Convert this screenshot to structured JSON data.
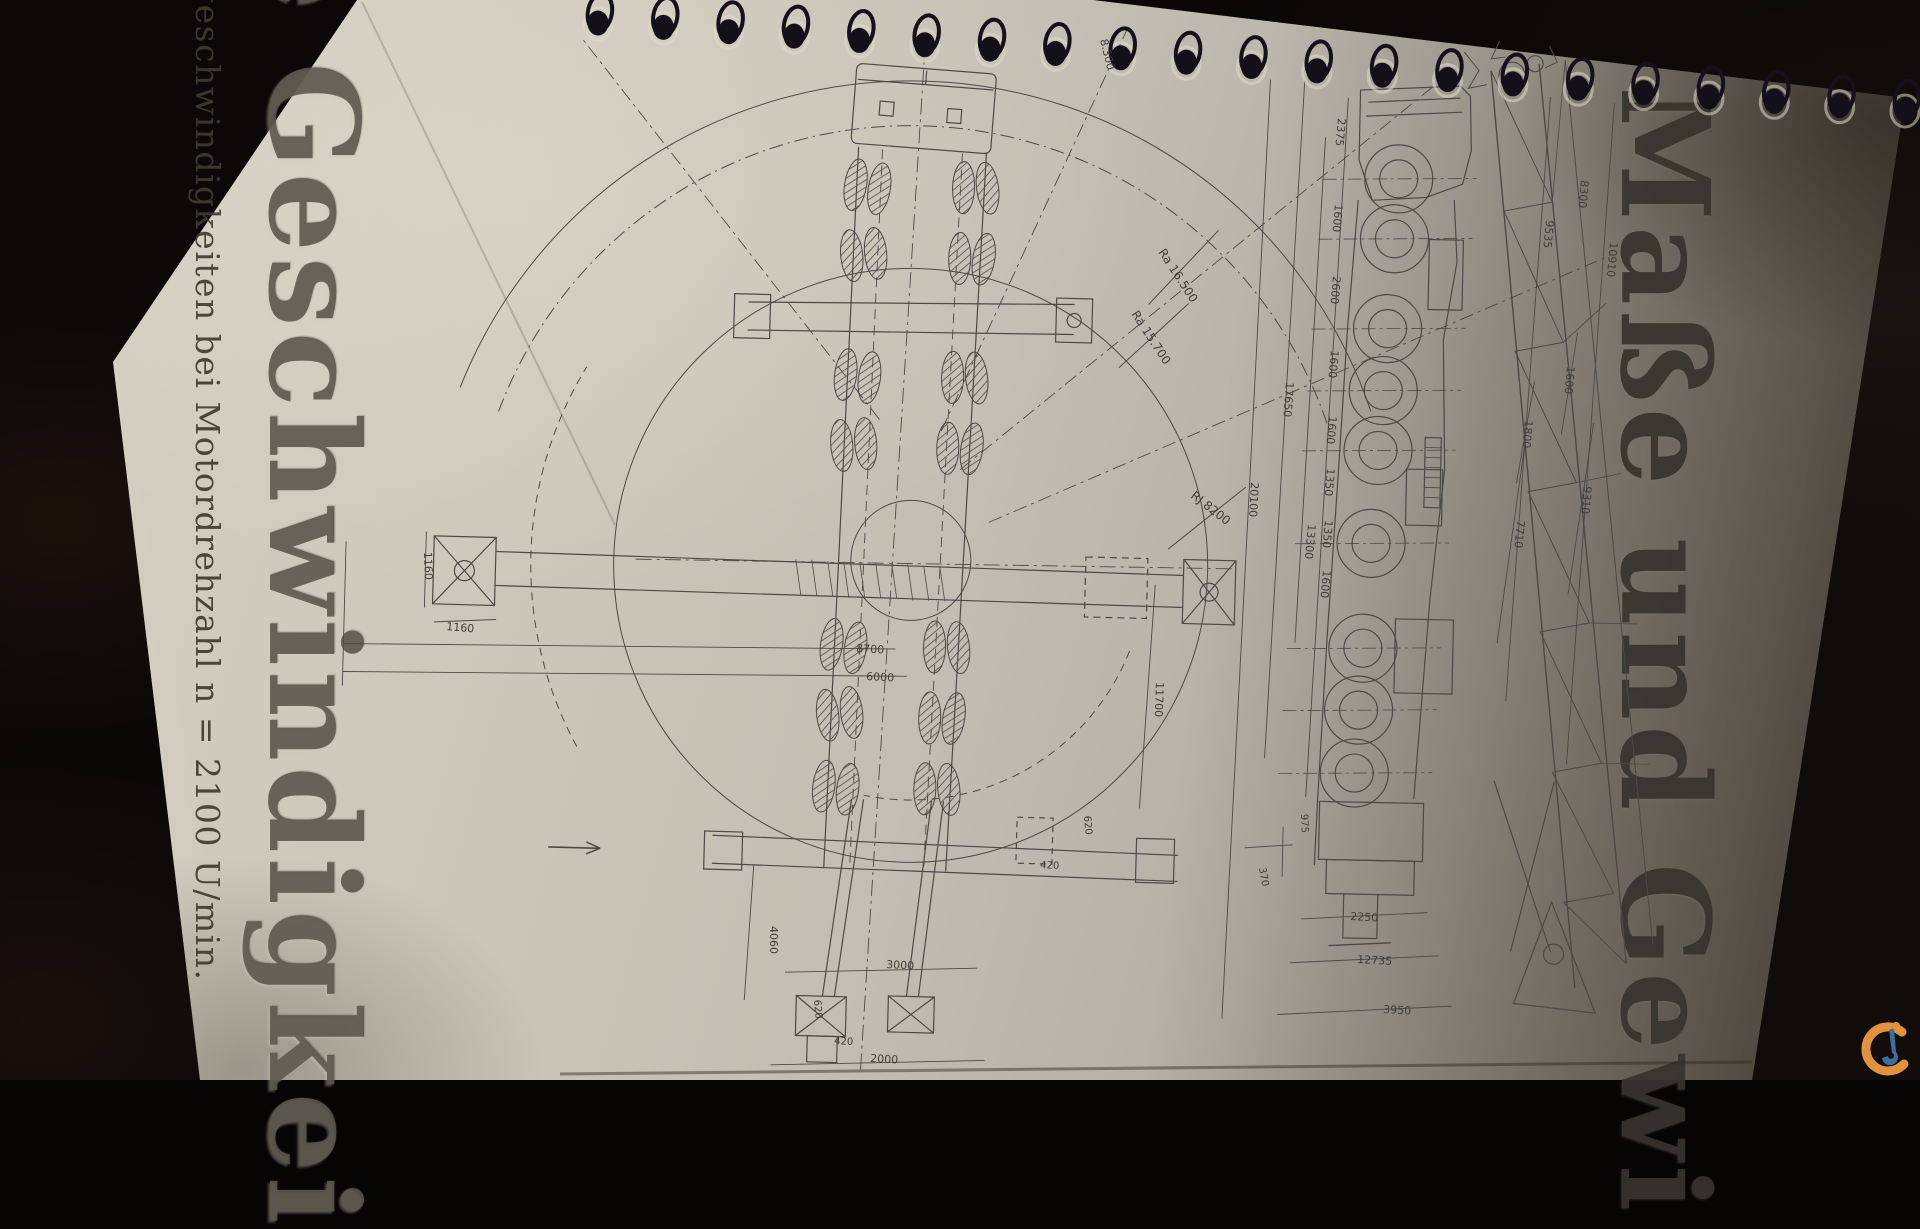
{
  "texts": {
    "heading_left": "e Geschwindigkei",
    "subtitle_left": "geschwindigkeiten bei Motordrehzahl n = 2100 U/min.",
    "heading_right": "Maße und Gewi"
  },
  "binding": {
    "ring_count": 21
  },
  "logo": {
    "name": "crane-network-watermark",
    "orange": "#e2923c",
    "blue": "#3c6e9f"
  },
  "dimension_labels": {
    "top_view": [
      {
        "t": "8.300",
        "x": 1100,
        "y": 40,
        "r": 76,
        "s": 11
      },
      {
        "t": "Ra 16.500",
        "x": 1158,
        "y": 252,
        "r": 57,
        "s": 12
      },
      {
        "t": "Ra 15.700",
        "x": 1131,
        "y": 314,
        "r": 57,
        "s": 12
      },
      {
        "t": "RJ 8200",
        "x": 1190,
        "y": 497,
        "r": 38,
        "s": 12
      },
      {
        "t": "1160",
        "x": 424,
        "y": 552,
        "r": 88,
        "s": 11
      },
      {
        "t": "1160",
        "x": 446,
        "y": 630,
        "r": 5,
        "s": 11
      },
      {
        "t": "8700",
        "x": 856,
        "y": 652,
        "r": 3,
        "s": 11
      },
      {
        "t": "6000",
        "x": 866,
        "y": 680,
        "r": 3,
        "s": 11
      },
      {
        "t": "20100",
        "x": 1251,
        "y": 482,
        "r": 93,
        "s": 11
      },
      {
        "t": "11700",
        "x": 1156,
        "y": 682,
        "r": 92,
        "s": 11
      },
      {
        "t": "4060",
        "x": 770,
        "y": 926,
        "r": 90,
        "s": 11
      },
      {
        "t": "3000",
        "x": 886,
        "y": 968,
        "r": 3,
        "s": 11
      },
      {
        "t": "2000",
        "x": 870,
        "y": 1062,
        "r": 3,
        "s": 11
      },
      {
        "t": "620",
        "x": 814,
        "y": 1000,
        "r": 85,
        "s": 10
      },
      {
        "t": "420",
        "x": 834,
        "y": 1044,
        "r": 3,
        "s": 10
      },
      {
        "t": "620",
        "x": 1084,
        "y": 816,
        "r": 85,
        "s": 10
      },
      {
        "t": "420",
        "x": 1040,
        "y": 868,
        "r": 3,
        "s": 10
      }
    ],
    "side_view": [
      {
        "t": "2375",
        "x": 1338,
        "y": 118,
        "r": 95,
        "s": 11
      },
      {
        "t": "1600",
        "x": 1335,
        "y": 204,
        "r": 95,
        "s": 11
      },
      {
        "t": "2600",
        "x": 1333,
        "y": 276,
        "r": 95,
        "s": 11
      },
      {
        "t": "1600",
        "x": 1331,
        "y": 350,
        "r": 95,
        "s": 11
      },
      {
        "t": "1600",
        "x": 1329,
        "y": 416,
        "r": 95,
        "s": 11
      },
      {
        "t": "1350",
        "x": 1327,
        "y": 468,
        "r": 95,
        "s": 11
      },
      {
        "t": "1350",
        "x": 1325,
        "y": 520,
        "r": 95,
        "s": 11
      },
      {
        "t": "1600",
        "x": 1323,
        "y": 570,
        "r": 95,
        "s": 11
      },
      {
        "t": "13300",
        "x": 1308,
        "y": 524,
        "r": 95,
        "s": 11
      },
      {
        "t": "17650",
        "x": 1286,
        "y": 382,
        "r": 94,
        "s": 11
      },
      {
        "t": "975",
        "x": 1301,
        "y": 814,
        "r": 88,
        "s": 10
      },
      {
        "t": "370",
        "x": 1259,
        "y": 868,
        "r": 80,
        "s": 10
      },
      {
        "t": "8300",
        "x": 1581,
        "y": 180,
        "r": 95,
        "s": 11
      },
      {
        "t": "9535",
        "x": 1546,
        "y": 220,
        "r": 95,
        "s": 11
      },
      {
        "t": "10910",
        "x": 1610,
        "y": 242,
        "r": 95,
        "s": 11
      },
      {
        "t": "1600",
        "x": 1567,
        "y": 366,
        "r": 95,
        "s": 11
      },
      {
        "t": "1800",
        "x": 1525,
        "y": 420,
        "r": 95,
        "s": 11
      },
      {
        "t": "7710",
        "x": 1517,
        "y": 520,
        "r": 95,
        "s": 11
      },
      {
        "t": "9310",
        "x": 1584,
        "y": 486,
        "r": 95,
        "s": 11
      },
      {
        "t": "2250",
        "x": 1350,
        "y": 920,
        "r": 3,
        "s": 11
      },
      {
        "t": "12735",
        "x": 1357,
        "y": 963,
        "r": 3,
        "s": 11
      },
      {
        "t": "3950",
        "x": 1383,
        "y": 1013,
        "r": 3,
        "s": 11
      }
    ]
  }
}
